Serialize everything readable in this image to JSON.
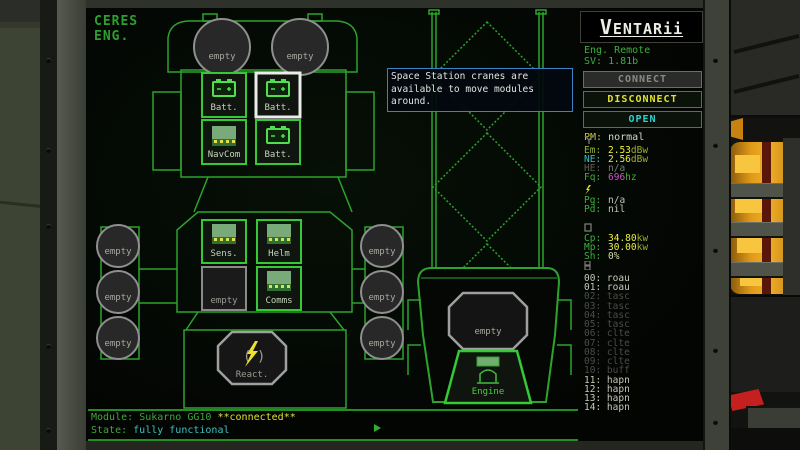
{
  "screen": {
    "station": {
      "line1": "CERES",
      "line2": "ENG."
    },
    "tooltip": {
      "line1": "Space Station cranes are",
      "line2": "available to move modules",
      "line3": "around."
    },
    "status": {
      "module_label": "Module:",
      "module_value": "Sukarno GG10",
      "connected": "**connected**",
      "state_label": "State:",
      "state_value": "fully functional"
    }
  },
  "ship": {
    "empty": "empty",
    "batt": "Batt.",
    "navcom": "NavCom",
    "sens": "Sens.",
    "helm": "Helm",
    "comms": "Comms",
    "react": "React.",
    "engine": "Engine"
  },
  "panel": {
    "logo": "VENTARii",
    "app": "Eng. Remote",
    "version": "SV: 1.81b",
    "connect": "CONNECT",
    "disconnect": "DISCONNECT",
    "open": "OPEN",
    "pm_label": "PM:",
    "pm_value": "normal",
    "em": {
      "label": "Em:",
      "value": "2.53",
      "unit": "dBw"
    },
    "ne": {
      "label": "NE:",
      "value": "2.56",
      "unit": "dBw"
    },
    "he": {
      "label": "HE:",
      "value": "n/a",
      "unit": ""
    },
    "fq": {
      "label": "Fq:",
      "value": "696",
      "unit": "hz"
    },
    "pg": {
      "label": "Pg:",
      "value": "n/a"
    },
    "pd": {
      "label": "Pd:",
      "value": "nil"
    },
    "cp": {
      "label": "Cp:",
      "value": "34.80",
      "unit": "kw"
    },
    "mp": {
      "label": "Mp:",
      "value": "30.00",
      "unit": "kw"
    },
    "sh": {
      "label": "Sh:",
      "value": "0%",
      "unit": ""
    },
    "channels": [
      {
        "num": "00:",
        "code": "roau"
      },
      {
        "num": "01:",
        "code": "roau"
      },
      {
        "num": "02:",
        "code": "tasc"
      },
      {
        "num": "03:",
        "code": "tasc"
      },
      {
        "num": "04:",
        "code": "tasc"
      },
      {
        "num": "05:",
        "code": "tasc"
      },
      {
        "num": "06:",
        "code": "clte"
      },
      {
        "num": "07:",
        "code": "clte"
      },
      {
        "num": "08:",
        "code": "clte"
      },
      {
        "num": "09:",
        "code": "clte"
      },
      {
        "num": "10:",
        "code": "buff"
      },
      {
        "num": "11:",
        "code": "hapn"
      },
      {
        "num": "12:",
        "code": "hapn"
      },
      {
        "num": "13:",
        "code": "hapn"
      },
      {
        "num": "14:",
        "code": "hapn"
      }
    ]
  }
}
